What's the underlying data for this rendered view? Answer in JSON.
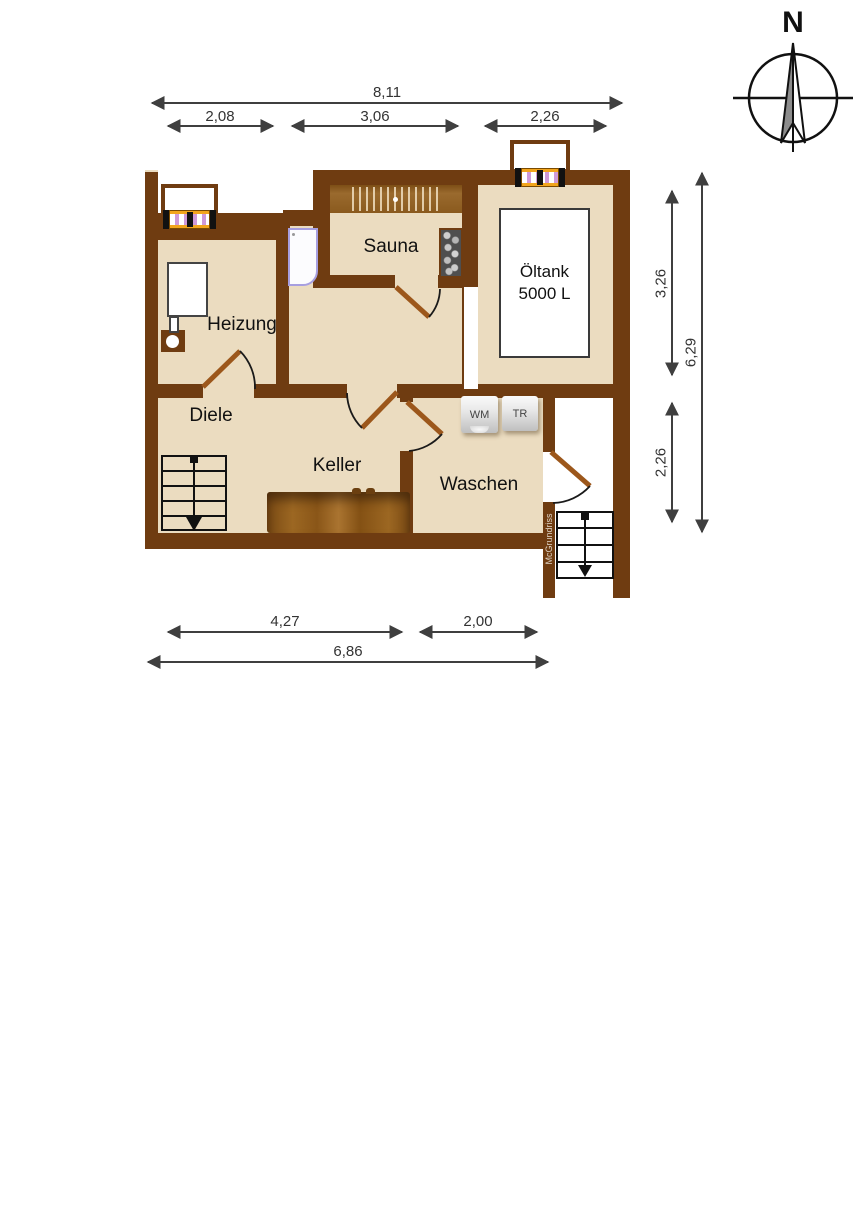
{
  "plan": {
    "rooms": {
      "heizung": "Heizung",
      "diele": "Diele",
      "sauna": "Sauna",
      "keller": "Keller",
      "waschen": "Waschen",
      "oeltank": {
        "line1": "Öltank",
        "line2": "5000 L"
      }
    },
    "appliances": {
      "wm": "WM",
      "tr": "TR"
    },
    "watermark": "McGrundriss",
    "compass": {
      "label": "N"
    },
    "dimensions": {
      "top": {
        "total": "8,11",
        "segments": [
          "2,08",
          "3,06",
          "2,26"
        ]
      },
      "right": {
        "segments": [
          "3,26",
          "2,26"
        ],
        "total": "6,29"
      },
      "bottom": {
        "segments": [
          "4,27",
          "2,00"
        ],
        "total": "6,86"
      }
    },
    "colors": {
      "wall": "#6f3c11",
      "floor": "#ebdcc0",
      "door_leaf": "#9c571b",
      "window_frame": "#f2a51d"
    }
  }
}
